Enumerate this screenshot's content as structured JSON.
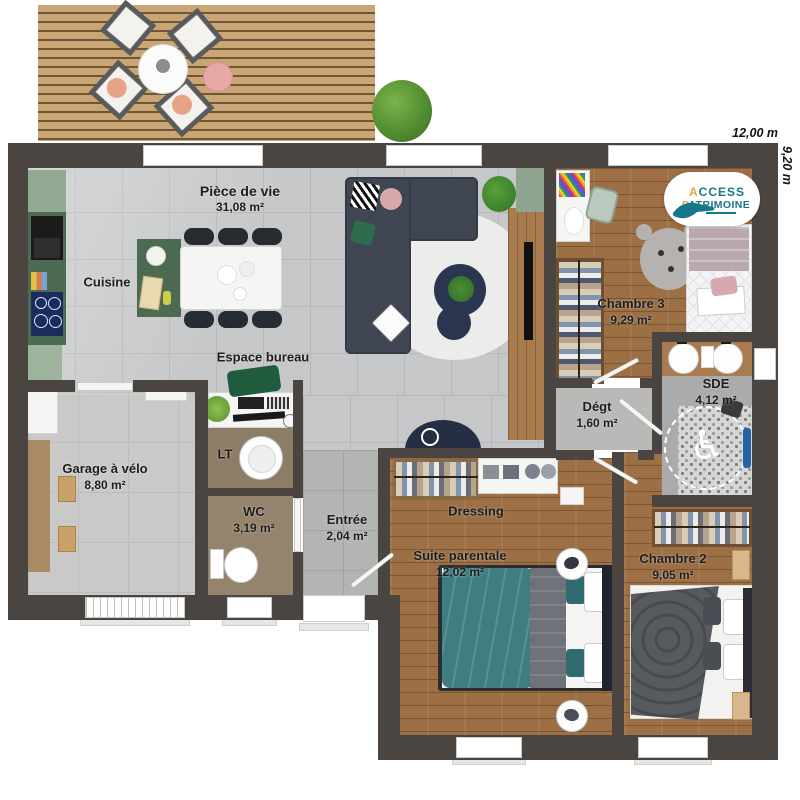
{
  "plan": {
    "brand": {
      "line1": "ACCESS",
      "line2": "PATRIMOINE"
    },
    "dimensions": {
      "width_label": "12,00 m",
      "height_label": "9,20 m"
    },
    "rooms": {
      "piece_de_vie": {
        "name": "Pièce de vie",
        "area": "31,08 m²"
      },
      "cuisine": {
        "name": "Cuisine",
        "area": ""
      },
      "espace_bureau": {
        "name": "Espace bureau",
        "area": ""
      },
      "chambre_3": {
        "name": "Chambre 3",
        "area": "9,29 m²"
      },
      "sde": {
        "name": "SDE",
        "area": "4,12 m²"
      },
      "degt": {
        "name": "Dégt",
        "area": "1,60 m²"
      },
      "garage": {
        "name": "Garage à vélo",
        "area": "8,80 m²"
      },
      "lt": {
        "name": "LT",
        "area": ""
      },
      "wc": {
        "name": "WC",
        "area": "3,19 m²"
      },
      "entree": {
        "name": "Entrée",
        "area": "2,04 m²"
      },
      "dressing": {
        "name": "Dressing",
        "area": ""
      },
      "suite_parentale": {
        "name": "Suite parentale",
        "area": "12,02 m²"
      },
      "chambre_2": {
        "name": "Chambre 2",
        "area": "9,05 m²"
      }
    },
    "colors": {
      "wall": "#4a4540",
      "wood_floor": "#9c6f45",
      "tile_floor": "#c6c7c9",
      "kitchen_green": "#4d6a52",
      "logo_teal": "#177789",
      "logo_orange": "#f0a03c",
      "bed_teal": "#3e7d82",
      "sofa_gray": "#3f4652"
    }
  }
}
